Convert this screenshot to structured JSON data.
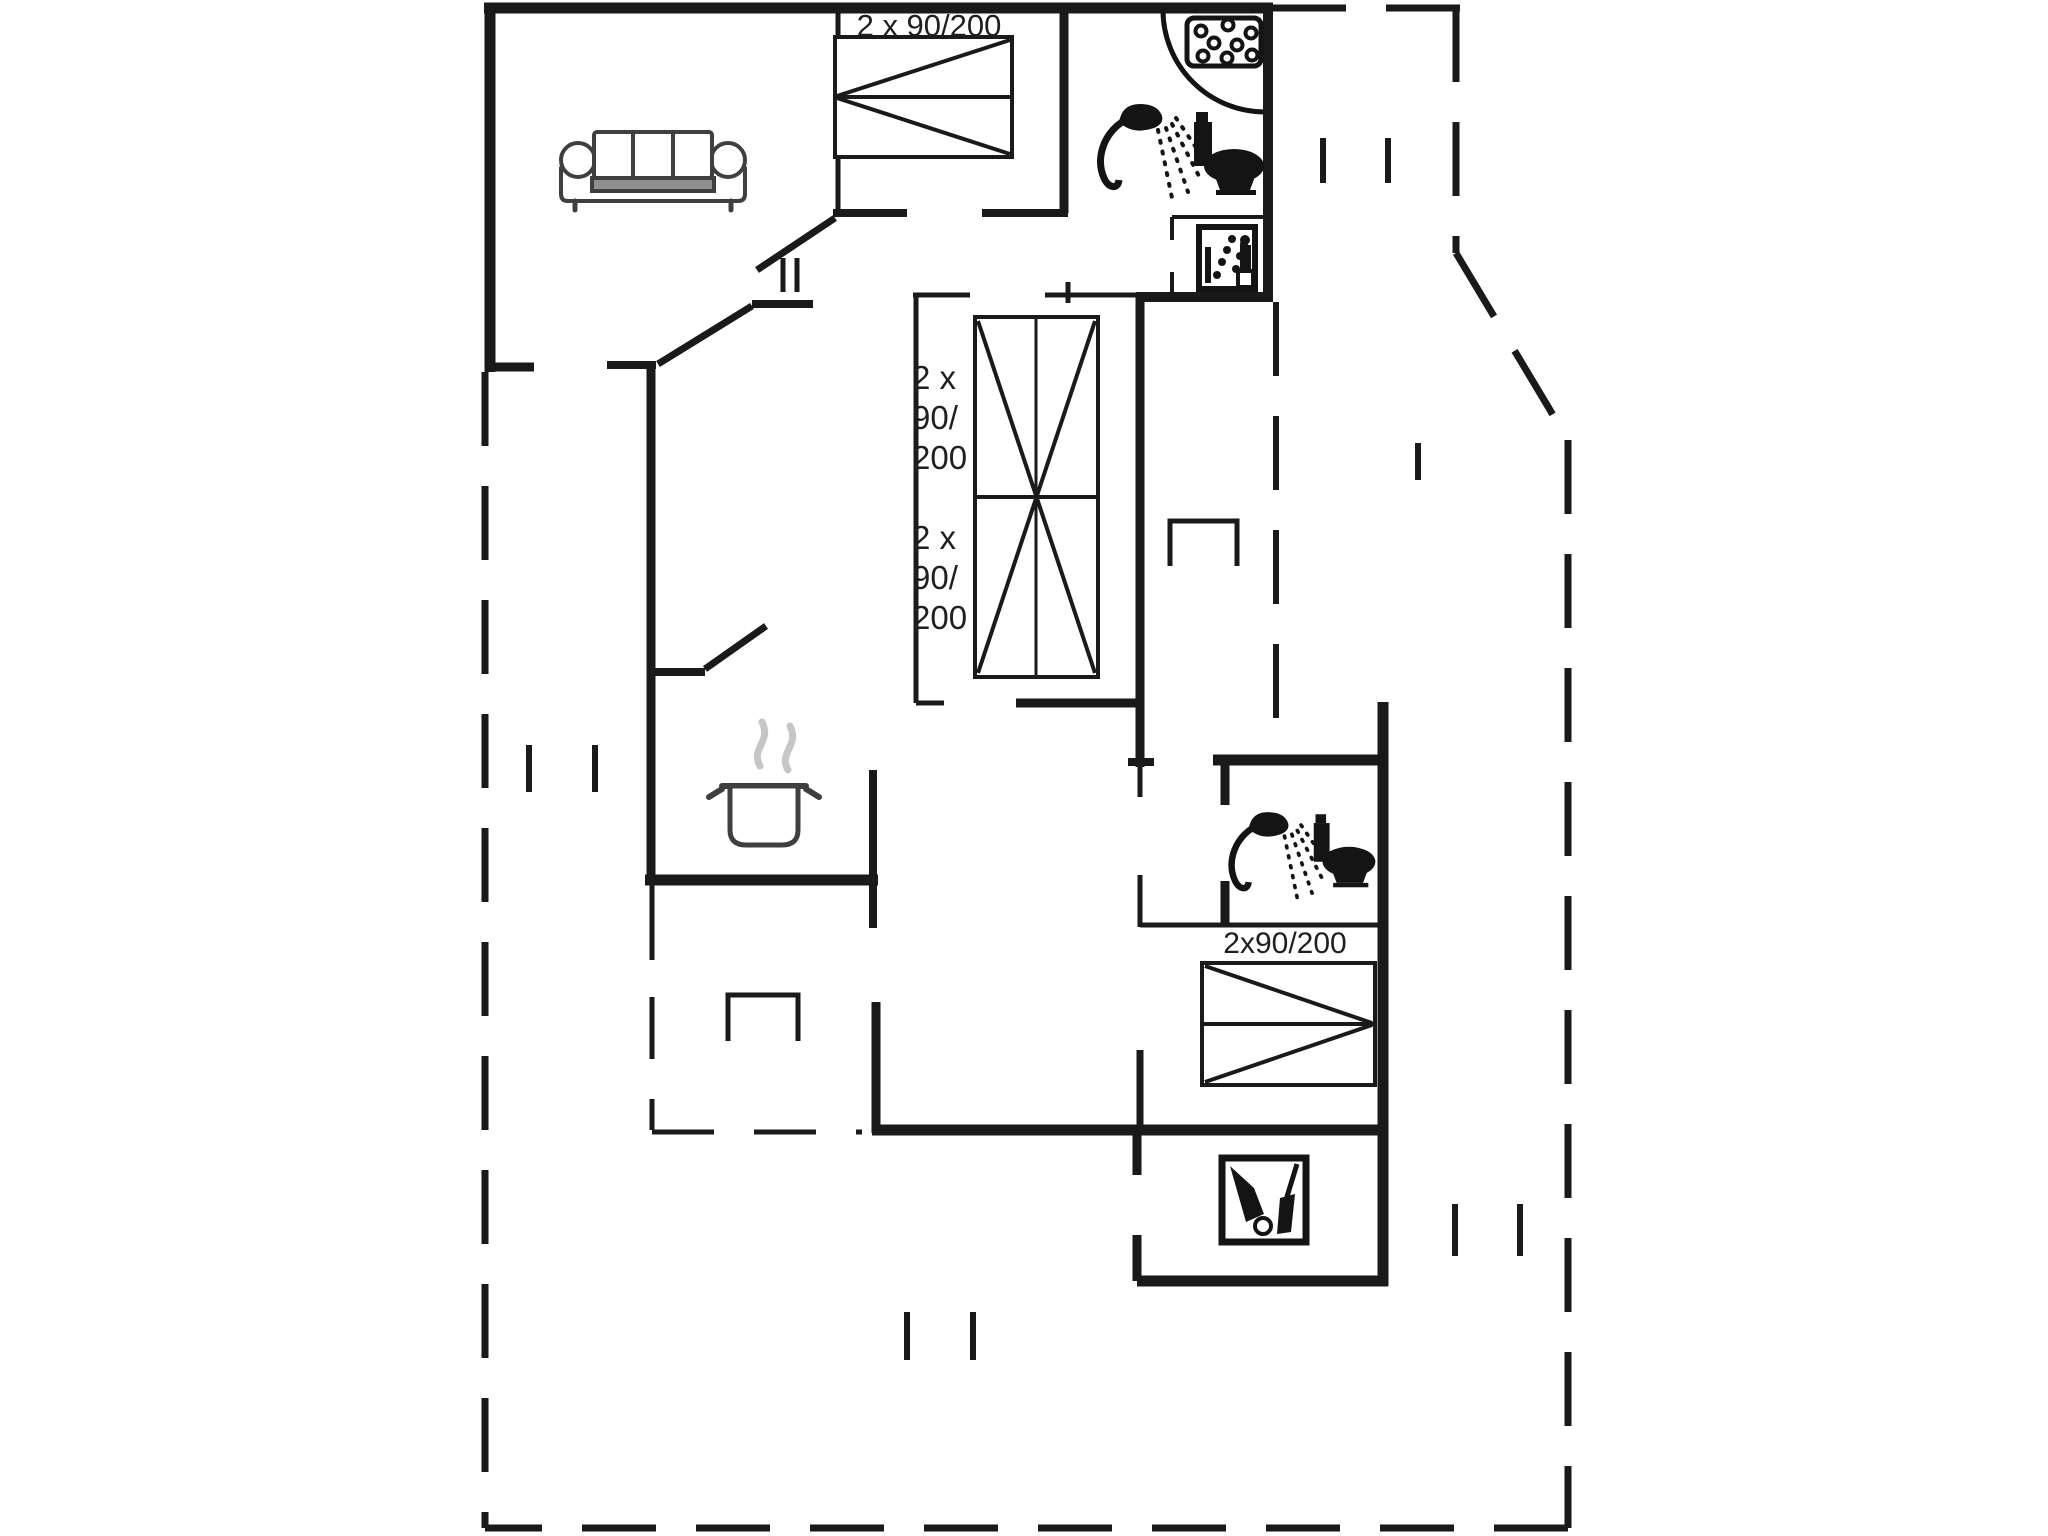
{
  "floor_plan": {
    "colors": {
      "background": "#ffffff",
      "line": "#1a1a1a",
      "furniture": "#3f3f3f",
      "icon": "#141414",
      "steam": "#c6c6c6"
    },
    "labels": {
      "top_bed": "2 x 90/200",
      "middle_bed_upper": [
        "2 x",
        "90/",
        "200"
      ],
      "middle_bed_lower": [
        "2 x",
        "90/",
        "200"
      ],
      "right_bed": "2x90/200"
    },
    "icons": {
      "sofa": "sofa-icon",
      "top_bathroom_shower": "shower-icon",
      "top_bathroom_toilet": "toilet-icon",
      "shower_tray": "shower-tray-drain-icon",
      "sauna": "sauna-icon",
      "kitchen_pot": "cooking-pot-icon",
      "lower_bathroom_shower": "shower-icon",
      "lower_bathroom_toilet": "toilet-icon",
      "utility_cleaning": "cleaning-equipment-icon",
      "beds": [
        "double-bed-icon",
        "double-bed-icon",
        "double-bed-icon"
      ]
    }
  }
}
